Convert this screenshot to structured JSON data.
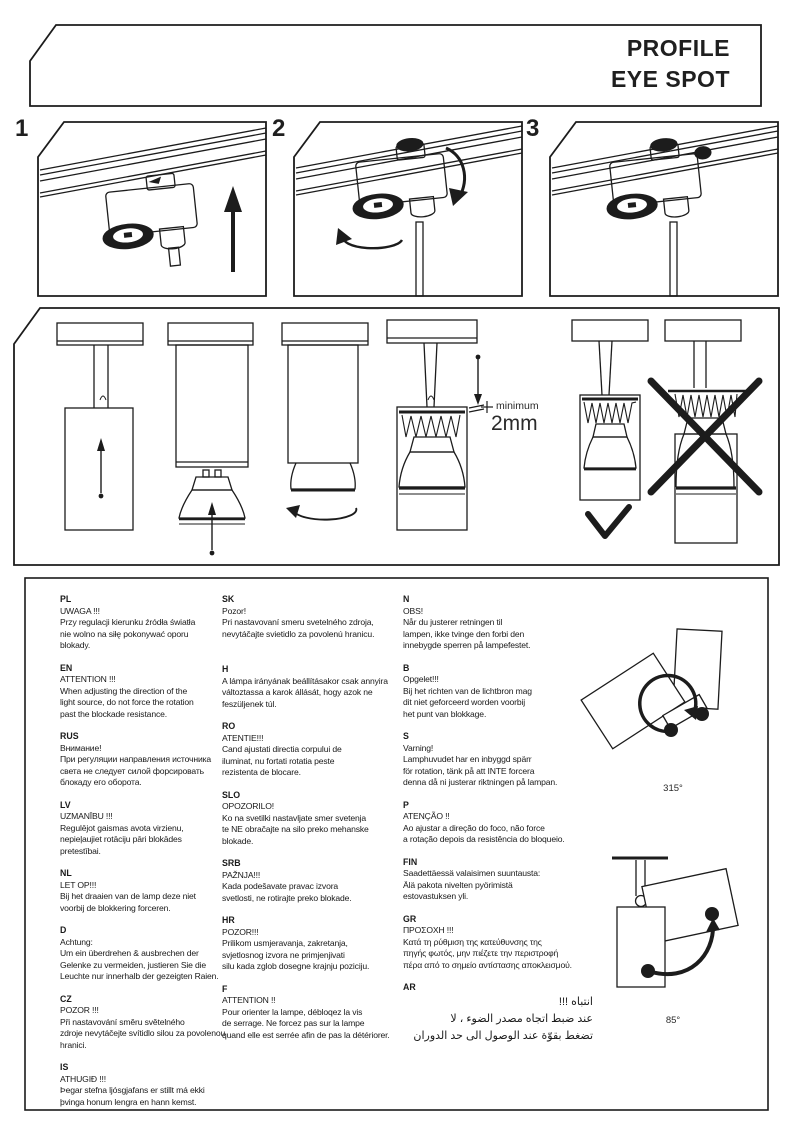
{
  "header": {
    "title_line1": "PROFILE",
    "title_line2": "EYE SPOT"
  },
  "steps": [
    {
      "number": "1"
    },
    {
      "number": "2"
    },
    {
      "number": "3"
    }
  ],
  "adjustment": {
    "min_gap_label": "minimum",
    "min_gap_value": "2mm"
  },
  "rotation_limits": {
    "horizontal": "315°",
    "vertical": "85°"
  },
  "warnings": {
    "col1": [
      {
        "code": "PL",
        "body": "UWAGA !!!\nPrzy regulacji kierunku źródła światła\nnie wolno na siłę pokonywać oporu\nblokady."
      },
      {
        "code": "EN",
        "body": "ATTENTION !!!\nWhen adjusting the direction of the\nlight source, do not force the rotation\npast the blockade resistance."
      },
      {
        "code": "RUS",
        "body": "Внимание!\nПри регуляции направления источника\nсвета не следует силой форсировать\nблокаду его оборота."
      },
      {
        "code": "LV",
        "body": "UZMANĪBU !!!\nRegulējot gaismas avota virzienu,\nnepieļaujiet rotāciju pāri blokādes\npretestībai."
      },
      {
        "code": "NL",
        "body": "LET OP!!!\nBij het draaien van de lamp deze niet\nvoorbij de blokkering forceren."
      },
      {
        "code": "D",
        "body": "Achtung:\nUm ein überdrehen & ausbrechen der\nGelenke zu vermeiden, justieren Sie die\nLeuchte nur innerhalb der gezeigten Raien."
      },
      {
        "code": "CZ",
        "body": "POZOR !!!\nPři nastavování směru světelného\nzdroje nevytáčejte svítidlo silou za povolenou\nhranici."
      },
      {
        "code": "IS",
        "body": "ATHUGIÐ !!!\nÞegar stefna ljósgjafans er stillt má ekki\nþvinga honum lengra en hann kemst."
      }
    ],
    "col2": [
      {
        "code": "SK",
        "body": "Pozor!\nPri nastavovaní smeru svetelného zdroja,\nnevytáčajte svietidlo za povolenú hranicu."
      },
      {
        "code": "H",
        "body": "A lámpa irányának beállításakor csak annyira\nváltoztassa a karok állását, hogy azok ne\nfeszüljenek túl."
      },
      {
        "code": "RO",
        "body": "ATENTIE!!!\nCand ajustati directia corpului de\niluminat, nu fortati rotatia peste\nrezistenta de blocare."
      },
      {
        "code": "SLO",
        "body": "OPOZORILO!\nKo na svetilki nastavljate smer svetenja\nte NE obračajte na silo preko mehanske\nblokade."
      },
      {
        "code": "SRB",
        "body": "PAŽNJA!!!\nKada podešavate pravac izvora\nsvetlosti, ne rotirajte preko blokade."
      },
      {
        "code": "HR",
        "body": "POZOR!!!\nPrilikom usmjeravanja, zakretanja,\nsvjetlosnog izvora ne primjenjivati\nsilu kada zglob dosegne krajnju poziciju."
      },
      {
        "code": "F",
        "body": "ATTENTION !!\nPour orienter la lampe, débloqez la vis\nde serrage. Ne forcez pas sur la lampe\nquand elle est serrée afin de pas la détériorer."
      }
    ],
    "col3": [
      {
        "code": "N",
        "body": "OBS!\nNår du justerer retningen til\nlampen, ikke tvinge den forbi den\ninnebygde sperren på lampefestet."
      },
      {
        "code": "B",
        "body": "Opgelet!!!\nBij het richten van de lichtbron mag\ndit niet geforceerd worden voorbij\nhet punt van blokkage."
      },
      {
        "code": "S",
        "body": "Varning!\nLamphuvudet har en inbyggd spärr\nför rotation, tänk på att INTE forcera\ndenna då ni justerar riktningen på lampan."
      },
      {
        "code": "P",
        "body": "ATENÇÃO !!\nAo ajustar a direção do foco, não force\na rotação depois da resistência do bloqueio."
      },
      {
        "code": "FIN",
        "body": "Saadettäessä valaisimen suuntausta:\nÄlä pakota nivelten pyörimistä\nestovastuksen yli."
      },
      {
        "code": "GR",
        "body": "ΠΡΟΣΟΧΗ !!!\nΚατά τη ρύθμιση της κατεύθυνσης της\nπηγής φωτός, μην πιέζετε την περιστροφή\nπέρα από το σημείο αντίστασης αποκλεισμού."
      },
      {
        "code": "AR",
        "body": "انتباه !!!\nعند ضبط اتجاه مصدر الضوء ، لا\nتضغط بقوّة عند الوصول الى حد الدوران"
      }
    ]
  }
}
